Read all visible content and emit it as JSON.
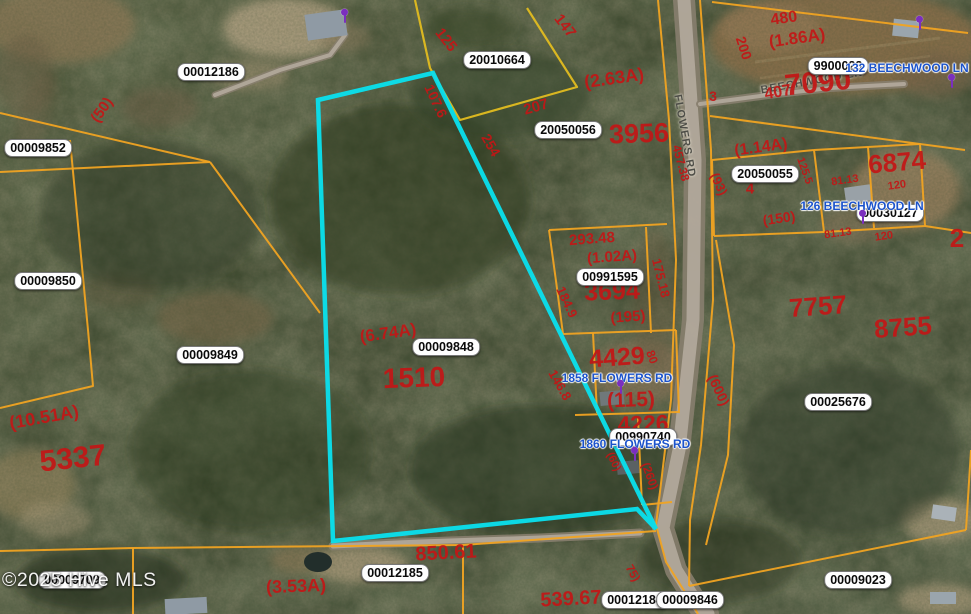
{
  "map": {
    "watermark": "©2025 Hive MLS",
    "colors": {
      "parcel_line": "#f0a322",
      "yellow_line": "#e2bc20",
      "highlight": "#0ae0ee",
      "red_text": "#c31616",
      "address_text": "#1b53cb",
      "marker": "#7b2fbe",
      "road_fill": "#877e6e",
      "road_center": "#b6ada0"
    },
    "parcel_id_labels": [
      {
        "t": "00012186",
        "x": 211,
        "y": 72
      },
      {
        "t": "00009852",
        "x": 38,
        "y": 148
      },
      {
        "t": "00009850",
        "x": 48,
        "y": 281
      },
      {
        "t": "00009849",
        "x": 210,
        "y": 355
      },
      {
        "t": "00009848",
        "x": 446,
        "y": 347
      },
      {
        "t": "20010664",
        "x": 497,
        "y": 60
      },
      {
        "t": "20050056",
        "x": 568,
        "y": 130
      },
      {
        "t": "00991595",
        "x": 610,
        "y": 277
      },
      {
        "t": "9900023",
        "x": 838,
        "y": 66
      },
      {
        "t": "20050055",
        "x": 765,
        "y": 174
      },
      {
        "t": "00030127",
        "x": 890,
        "y": 213
      },
      {
        "t": "00990740",
        "x": 643,
        "y": 437
      },
      {
        "t": "00025676",
        "x": 838,
        "y": 402
      },
      {
        "t": "00012185",
        "x": 395,
        "y": 573
      },
      {
        "t": "00012184",
        "x": 635,
        "y": 600
      },
      {
        "t": "00009846",
        "x": 690,
        "y": 600
      },
      {
        "t": "00009023",
        "x": 858,
        "y": 580
      },
      {
        "t": "00009709",
        "x": 72,
        "y": 580
      }
    ],
    "red_labels": [
      {
        "t": "(50)",
        "x": 102,
        "y": 110,
        "r": -55,
        "s": 15
      },
      {
        "t": "125",
        "x": 446,
        "y": 40,
        "r": 52,
        "s": 15
      },
      {
        "t": "147",
        "x": 565,
        "y": 26,
        "r": 52,
        "s": 15
      },
      {
        "t": "107.6",
        "x": 436,
        "y": 101,
        "r": 65,
        "s": 14
      },
      {
        "t": "254",
        "x": 491,
        "y": 145,
        "r": 60,
        "s": 14
      },
      {
        "t": "207",
        "x": 536,
        "y": 107,
        "r": -16,
        "s": 15
      },
      {
        "t": "(2.63A)",
        "x": 614,
        "y": 78,
        "r": -8,
        "s": 18
      },
      {
        "t": "3956",
        "x": 639,
        "y": 134,
        "r": -2,
        "s": 27
      },
      {
        "t": "480",
        "x": 784,
        "y": 19,
        "r": -8,
        "s": 16
      },
      {
        "t": "(1.86A)",
        "x": 797,
        "y": 38,
        "r": -8,
        "s": 17
      },
      {
        "t": "200",
        "x": 744,
        "y": 48,
        "r": 72,
        "s": 14
      },
      {
        "t": "3",
        "x": 713,
        "y": 96,
        "r": 0,
        "s": 14
      },
      {
        "t": "407",
        "x": 778,
        "y": 93,
        "r": -10,
        "s": 16
      },
      {
        "t": "7090",
        "x": 818,
        "y": 83,
        "r": -6,
        "s": 30
      },
      {
        "t": "(1.14A)",
        "x": 761,
        "y": 148,
        "r": -8,
        "s": 16
      },
      {
        "t": "6874",
        "x": 897,
        "y": 162,
        "r": -5,
        "s": 26
      },
      {
        "t": "457.38",
        "x": 681,
        "y": 163,
        "r": 75,
        "s": 12
      },
      {
        "t": "(93)",
        "x": 719,
        "y": 184,
        "r": 65,
        "s": 13
      },
      {
        "t": "4",
        "x": 750,
        "y": 189,
        "r": 0,
        "s": 15
      },
      {
        "t": "125.5",
        "x": 804,
        "y": 171,
        "r": 70,
        "s": 11
      },
      {
        "t": "81.13",
        "x": 845,
        "y": 181,
        "r": -8,
        "s": 11
      },
      {
        "t": "120",
        "x": 897,
        "y": 186,
        "r": -8,
        "s": 11
      },
      {
        "t": "(150)",
        "x": 779,
        "y": 218,
        "r": -8,
        "s": 14
      },
      {
        "t": "81.13",
        "x": 838,
        "y": 234,
        "r": -8,
        "s": 11
      },
      {
        "t": "120",
        "x": 884,
        "y": 237,
        "r": -8,
        "s": 11
      },
      {
        "t": "2",
        "x": 957,
        "y": 238,
        "r": 0,
        "s": 26
      },
      {
        "t": "293.48",
        "x": 592,
        "y": 239,
        "r": -4,
        "s": 15
      },
      {
        "t": "(1.02A)",
        "x": 612,
        "y": 257,
        "r": -4,
        "s": 15
      },
      {
        "t": "3694",
        "x": 612,
        "y": 292,
        "r": -2,
        "s": 25
      },
      {
        "t": "(195)",
        "x": 628,
        "y": 317,
        "r": -4,
        "s": 15
      },
      {
        "t": "175.18",
        "x": 661,
        "y": 278,
        "r": 76,
        "s": 13
      },
      {
        "t": "184.9",
        "x": 567,
        "y": 302,
        "r": 65,
        "s": 13
      },
      {
        "t": "7757",
        "x": 818,
        "y": 306,
        "r": -4,
        "s": 26
      },
      {
        "t": "8755",
        "x": 903,
        "y": 327,
        "r": -4,
        "s": 26
      },
      {
        "t": "(10.51A)",
        "x": 44,
        "y": 417,
        "r": -10,
        "s": 18
      },
      {
        "t": "5337",
        "x": 73,
        "y": 459,
        "r": -6,
        "s": 30
      },
      {
        "t": "(6.74A)",
        "x": 388,
        "y": 333,
        "r": -8,
        "s": 17
      },
      {
        "t": "1510",
        "x": 414,
        "y": 378,
        "r": -2,
        "s": 28
      },
      {
        "t": "4429",
        "x": 617,
        "y": 358,
        "r": -4,
        "s": 25
      },
      {
        "t": "80",
        "x": 652,
        "y": 357,
        "r": 70,
        "s": 12
      },
      {
        "t": "146.8",
        "x": 560,
        "y": 385,
        "r": 60,
        "s": 13
      },
      {
        "t": "(115)",
        "x": 631,
        "y": 400,
        "r": -2,
        "s": 21
      },
      {
        "t": "(600)",
        "x": 719,
        "y": 390,
        "r": 65,
        "s": 14
      },
      {
        "t": "4226",
        "x": 643,
        "y": 424,
        "r": -2,
        "s": 23
      },
      {
        "t": "(60)",
        "x": 613,
        "y": 462,
        "r": 65,
        "s": 11
      },
      {
        "t": "(260)",
        "x": 650,
        "y": 476,
        "r": 70,
        "s": 12
      },
      {
        "t": "850.61",
        "x": 446,
        "y": 553,
        "r": -3,
        "s": 20
      },
      {
        "t": "539.67",
        "x": 571,
        "y": 599,
        "r": -3,
        "s": 20
      },
      {
        "t": "(3.53A)",
        "x": 296,
        "y": 586,
        "r": -2,
        "s": 18
      },
      {
        "t": "75)",
        "x": 633,
        "y": 573,
        "r": 60,
        "s": 12
      }
    ],
    "address_labels": [
      {
        "t": "132 BEECHWOOD LN",
        "x": 907,
        "y": 68
      },
      {
        "t": "126 BEECHWOOD LN",
        "x": 862,
        "y": 206
      },
      {
        "t": "1858 FLOWERS RD",
        "x": 617,
        "y": 378
      },
      {
        "t": "1860 FLOWERS RD",
        "x": 635,
        "y": 444
      }
    ],
    "road_labels": [
      {
        "t": "FLOWERS RD",
        "x": 684,
        "y": 136,
        "r": 80
      },
      {
        "t": "BEECHWOOD LN",
        "x": 812,
        "y": 82,
        "r": -10
      }
    ],
    "markers": [
      {
        "x": 345,
        "y": 17
      },
      {
        "x": 920,
        "y": 24
      },
      {
        "x": 952,
        "y": 82
      },
      {
        "x": 863,
        "y": 218
      },
      {
        "x": 621,
        "y": 388
      },
      {
        "x": 635,
        "y": 455
      }
    ],
    "geometry": {
      "highlight_polygon": [
        [
          318,
          100
        ],
        [
          433,
          73
        ],
        [
          656,
          529
        ],
        [
          637,
          509
        ],
        [
          333,
          541
        ]
      ],
      "yellow_lines": [
        [
          [
            415,
            0
          ],
          [
            430,
            68
          ],
          [
            460,
            120
          ],
          [
            577,
            87
          ],
          [
            527,
            8
          ]
        ]
      ],
      "orange_lines": [
        [
          [
            0,
            113
          ],
          [
            210,
            162
          ]
        ],
        [
          [
            0,
            172
          ],
          [
            210,
            162
          ]
        ],
        [
          [
            210,
            162
          ],
          [
            320,
            313
          ]
        ],
        [
          [
            70,
            140
          ],
          [
            88,
            330
          ],
          [
            93,
            386
          ],
          [
            0,
            408
          ]
        ],
        [
          [
            0,
            551
          ],
          [
            133,
            548
          ],
          [
            463,
            545
          ],
          [
            656,
            531
          ]
        ],
        [
          [
            133,
            548
          ],
          [
            133,
            614
          ]
        ],
        [
          [
            463,
            545
          ],
          [
            463,
            614
          ]
        ],
        [
          [
            689,
            586
          ],
          [
            966,
            530
          ]
        ],
        [
          [
            658,
            0
          ],
          [
            669,
            120
          ],
          [
            676,
            260
          ],
          [
            671,
            400
          ],
          [
            656,
            525
          ],
          [
            666,
            562
          ],
          [
            690,
            600
          ],
          [
            698,
            614
          ]
        ],
        [
          [
            700,
            0
          ],
          [
            711,
            150
          ],
          [
            713,
            300
          ],
          [
            701,
            445
          ],
          [
            690,
            520
          ],
          [
            689,
            586
          ]
        ],
        [
          [
            712,
            2
          ],
          [
            968,
            33
          ]
        ],
        [
          [
            710,
            116
          ],
          [
            965,
            150
          ]
        ],
        [
          [
            814,
            150
          ],
          [
            920,
            144
          ],
          [
            925,
            226
          ],
          [
            824,
            232
          ],
          [
            814,
            150
          ]
        ],
        [
          [
            868,
            147
          ],
          [
            874,
            228
          ]
        ],
        [
          [
            712,
            160
          ],
          [
            814,
            150
          ]
        ],
        [
          [
            712,
            160
          ],
          [
            714,
            236
          ]
        ],
        [
          [
            714,
            236
          ],
          [
            824,
            232
          ]
        ],
        [
          [
            925,
            226
          ],
          [
            971,
            233
          ]
        ],
        [
          [
            549,
            230
          ],
          [
            667,
            224
          ]
        ],
        [
          [
            549,
            230
          ],
          [
            556,
            281
          ],
          [
            563,
            334
          ]
        ],
        [
          [
            646,
            227
          ],
          [
            651,
            333
          ]
        ],
        [
          [
            563,
            334
          ],
          [
            676,
            330
          ]
        ],
        [
          [
            676,
            330
          ],
          [
            679,
            413
          ]
        ],
        [
          [
            575,
            415
          ],
          [
            678,
            412
          ]
        ],
        [
          [
            638,
            418
          ],
          [
            642,
            505
          ]
        ],
        [
          [
            716,
            240
          ],
          [
            734,
            345
          ],
          [
            728,
            455
          ],
          [
            706,
            545
          ]
        ],
        [
          [
            593,
            333
          ],
          [
            597,
            413
          ]
        ],
        [
          [
            642,
            505
          ],
          [
            672,
            502
          ]
        ],
        [
          [
            971,
            450
          ],
          [
            966,
            530
          ]
        ]
      ],
      "roads": [
        {
          "name": "flowers-rd",
          "outer": 22,
          "inner": 13,
          "points": [
            [
              684,
              0
            ],
            [
              695,
              160
            ],
            [
              693,
              320
            ],
            [
              679,
              450
            ],
            [
              663,
              528
            ],
            [
              676,
              570
            ],
            [
              700,
              608
            ],
            [
              708,
              614
            ]
          ]
        },
        {
          "name": "beechwood-ln",
          "outer": 8,
          "inner": 4,
          "points": [
            [
              700,
              104
            ],
            [
              768,
              95
            ],
            [
              830,
              88
            ],
            [
              904,
              84
            ]
          ]
        },
        {
          "name": "bottom-driveway",
          "outer": 9,
          "inner": 5,
          "points": [
            [
              333,
              546
            ],
            [
              420,
              542
            ],
            [
              540,
              538
            ],
            [
              640,
              533
            ]
          ]
        },
        {
          "name": "top-driveway",
          "outer": 7,
          "inner": 4,
          "points": [
            [
              215,
              95
            ],
            [
              280,
              70
            ],
            [
              330,
              55
            ],
            [
              345,
              35
            ]
          ]
        }
      ]
    }
  }
}
